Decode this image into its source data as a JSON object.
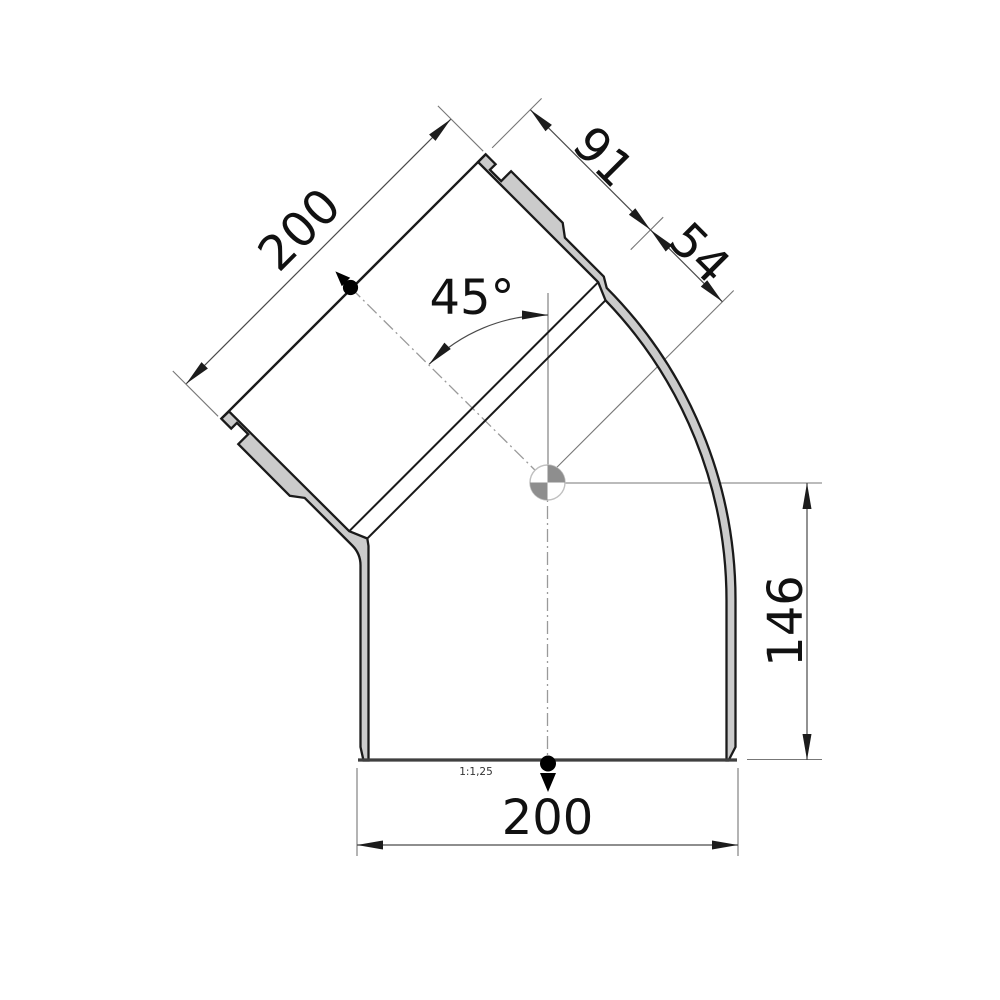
{
  "drawing": {
    "labels": {
      "mouth_width": "200",
      "socket_depth": "91",
      "socket_to_center": "54",
      "bend_angle": "45°",
      "center_height": "146",
      "base_width": "200",
      "scale_note": "1:1,25"
    },
    "colors": {
      "background": "#ffffff",
      "wall_fill": "#cbcbcb",
      "outline": "#1a1a1a",
      "dimension_line": "#4a4a4a",
      "extension_line": "#777777",
      "centerline": "#9a9a9a",
      "centroid_fill": "#8e8e8e",
      "centroid_ring": "#c0c0c0",
      "connection_marker": "#000000"
    },
    "symbols": {
      "centroid": "center-of-gravity-marker",
      "inlet_marker": "connection-point-arrow",
      "outlet_marker": "connection-point-arrow"
    }
  }
}
